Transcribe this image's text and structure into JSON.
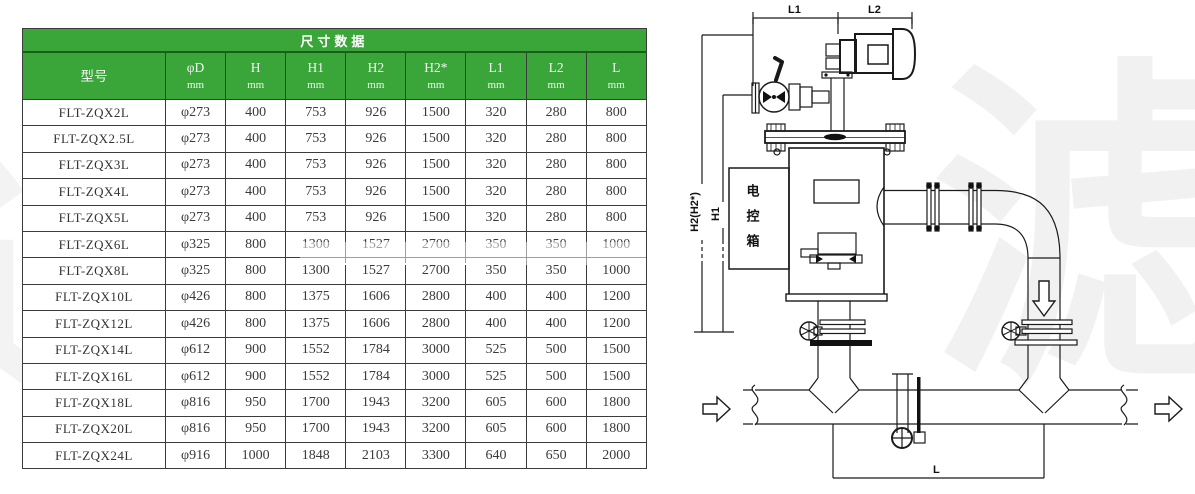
{
  "table": {
    "title": "尺寸数据",
    "columns": [
      {
        "label": "型号",
        "unit": ""
      },
      {
        "label": "φD",
        "unit": "mm"
      },
      {
        "label": "H",
        "unit": "mm"
      },
      {
        "label": "H1",
        "unit": "mm"
      },
      {
        "label": "H2",
        "unit": "mm"
      },
      {
        "label": "H2*",
        "unit": "mm"
      },
      {
        "label": "L1",
        "unit": "mm"
      },
      {
        "label": "L2",
        "unit": "mm"
      },
      {
        "label": "L",
        "unit": "mm"
      }
    ],
    "rows": [
      [
        "FLT-ZQX2L",
        "φ273",
        "400",
        "753",
        "926",
        "1500",
        "320",
        "280",
        "800"
      ],
      [
        "FLT-ZQX2.5L",
        "φ273",
        "400",
        "753",
        "926",
        "1500",
        "320",
        "280",
        "800"
      ],
      [
        "FLT-ZQX3L",
        "φ273",
        "400",
        "753",
        "926",
        "1500",
        "320",
        "280",
        "800"
      ],
      [
        "FLT-ZQX4L",
        "φ273",
        "400",
        "753",
        "926",
        "1500",
        "320",
        "280",
        "800"
      ],
      [
        "FLT-ZQX5L",
        "φ273",
        "400",
        "753",
        "926",
        "1500",
        "320",
        "280",
        "800"
      ],
      [
        "FLT-ZQX6L",
        "φ325",
        "800",
        "1300",
        "1527",
        "2700",
        "350",
        "350",
        "1000"
      ],
      [
        "FLT-ZQX8L",
        "φ325",
        "800",
        "1300",
        "1527",
        "2700",
        "350",
        "350",
        "1000"
      ],
      [
        "FLT-ZQX10L",
        "φ426",
        "800",
        "1375",
        "1606",
        "2800",
        "400",
        "400",
        "1200"
      ],
      [
        "FLT-ZQX12L",
        "φ426",
        "800",
        "1375",
        "1606",
        "2800",
        "400",
        "400",
        "1200"
      ],
      [
        "FLT-ZQX14L",
        "φ612",
        "900",
        "1552",
        "1784",
        "3000",
        "525",
        "500",
        "1500"
      ],
      [
        "FLT-ZQX16L",
        "φ612",
        "900",
        "1552",
        "1784",
        "3000",
        "525",
        "500",
        "1500"
      ],
      [
        "FLT-ZQX18L",
        "φ816",
        "950",
        "1700",
        "1943",
        "3200",
        "605",
        "600",
        "1800"
      ],
      [
        "FLT-ZQX20L",
        "φ816",
        "950",
        "1700",
        "1943",
        "3200",
        "605",
        "600",
        "1800"
      ],
      [
        "FLT-ZQX24L",
        "φ916",
        "1000",
        "1848",
        "2103",
        "3300",
        "640",
        "650",
        "2000"
      ]
    ]
  },
  "diagram": {
    "dim_l1": "L1",
    "dim_l2": "L2",
    "dim_h2": "H2(H2*)",
    "dim_h1": "H1",
    "dim_l": "L",
    "control_box_label": "电控箱"
  },
  "watermark_glyphs": [
    "过",
    "滤",
    "过"
  ],
  "colors": {
    "header_green": "#3aa63a",
    "header_green_dark_line": "#1b5e1b",
    "table_line": "#3c3c3c",
    "drawing_line": "#1a1a1a"
  }
}
